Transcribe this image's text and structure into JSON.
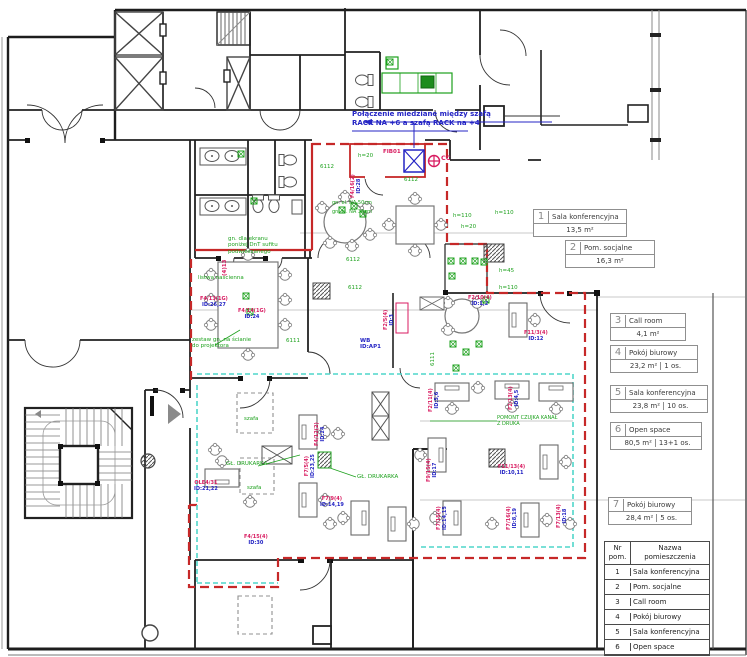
{
  "note": {
    "line1": "Połączenie miedziane między szafą",
    "line2": "RACK NA +6 a szafą RACK na +4"
  },
  "rooms": [
    {
      "num": "1",
      "name": "Sala konferencyjna",
      "area": "13,5 m²",
      "persons": ""
    },
    {
      "num": "2",
      "name": "Pom. socjalne",
      "area": "16,3 m²",
      "persons": ""
    },
    {
      "num": "3",
      "name": "Call room",
      "area": "4,1 m²",
      "persons": ""
    },
    {
      "num": "4",
      "name": "Pokój biurowy",
      "area": "23,2 m²",
      "persons": "1 os."
    },
    {
      "num": "5",
      "name": "Sala konferencyjna",
      "area": "23,8 m²",
      "persons": "10 os."
    },
    {
      "num": "6",
      "name": "Open space",
      "area": "80,5 m²",
      "persons": "13+1 os."
    },
    {
      "num": "7",
      "name": "Pokój biurowy",
      "area": "28,4 m²",
      "persons": "5 os."
    }
  ],
  "legend_table": {
    "header_nr": "Nr\npom.",
    "header_name": "Nazwa\npomieszczenia",
    "rows": [
      {
        "nr": "1",
        "name": "Sala konferencyjna"
      },
      {
        "nr": "2",
        "name": "Pom. socjalne"
      },
      {
        "nr": "3",
        "name": "Call room"
      },
      {
        "nr": "4",
        "name": "Pokój biurowy"
      },
      {
        "nr": "5",
        "name": "Sala konferencyjna"
      },
      {
        "nr": "6",
        "name": "Open space"
      }
    ]
  },
  "ann": {
    "c6112": "6112",
    "c6111": "6111",
    "h20": "h=20",
    "h45": "h=45",
    "h110": "h=110",
    "printer": "GŁ. DRUKARKA",
    "screen1": "gn. dla ekranu",
    "screen2": "poniżej DnT sufitu",
    "screen3": "podwieszanego",
    "proj1": "zestaw gn. na ścianie",
    "proj2": "do projektora",
    "strip": "listwa naścienna",
    "sensor1": "POMONT CZUJKA KANAŁ",
    "sensor2": "Z DRUKA",
    "cc": "CC",
    "fib": "FIB01",
    "wb": "WB",
    "ap": "ID:AP1",
    "f413": "(4)13",
    "cab": "szafa",
    "na50": "gn. el. NA 50cm",
    "na30": "gn. el. NA 30cm"
  },
  "desk_labels": [
    {
      "a": "F4/13(1G)",
      "b": "ID:26,27"
    },
    {
      "a": "F4/14(1G)",
      "b": "ID:24"
    },
    {
      "a": "F4/16(2)",
      "b": "ID:28"
    },
    {
      "a": "F2/5(4)",
      "b": "ID:3"
    },
    {
      "a": "F2/10(4)",
      "b": "ID:1,2"
    },
    {
      "a": "F2/11(4)",
      "b": "ID:5,6"
    },
    {
      "a": "F2/13(4)",
      "b": "ID:4,5"
    },
    {
      "a": "F4/12(2)",
      "b": "ID:24"
    },
    {
      "a": "F7/5(4)",
      "b": "ID:23,25"
    },
    {
      "a": "OLE4/31",
      "b": "ID:21,22"
    },
    {
      "a": "F9/15(4)",
      "b": "ID:17"
    },
    {
      "a": "F7/9(4)",
      "b": "ID:14,19"
    },
    {
      "a": "F11/13(4)",
      "b": "ID:10,11"
    },
    {
      "a": "F7/15(4)",
      "b": "ID:14,15"
    },
    {
      "a": "F7/16(4)",
      "b": "ID:8,19"
    },
    {
      "a": "F4/15(4)",
      "b": "ID:30"
    },
    {
      "a": "F7/13(4)",
      "b": "ID:18"
    },
    {
      "a": "F11/3(4)",
      "b": "ID:12"
    }
  ],
  "colors": {
    "boundary_red": "#c62828",
    "zone_cyan": "#4fd6ca",
    "electric_green": "#1da11d",
    "circuit_red": "#d81b60",
    "circuit_blue": "#2424c4",
    "wall": "#222222"
  }
}
